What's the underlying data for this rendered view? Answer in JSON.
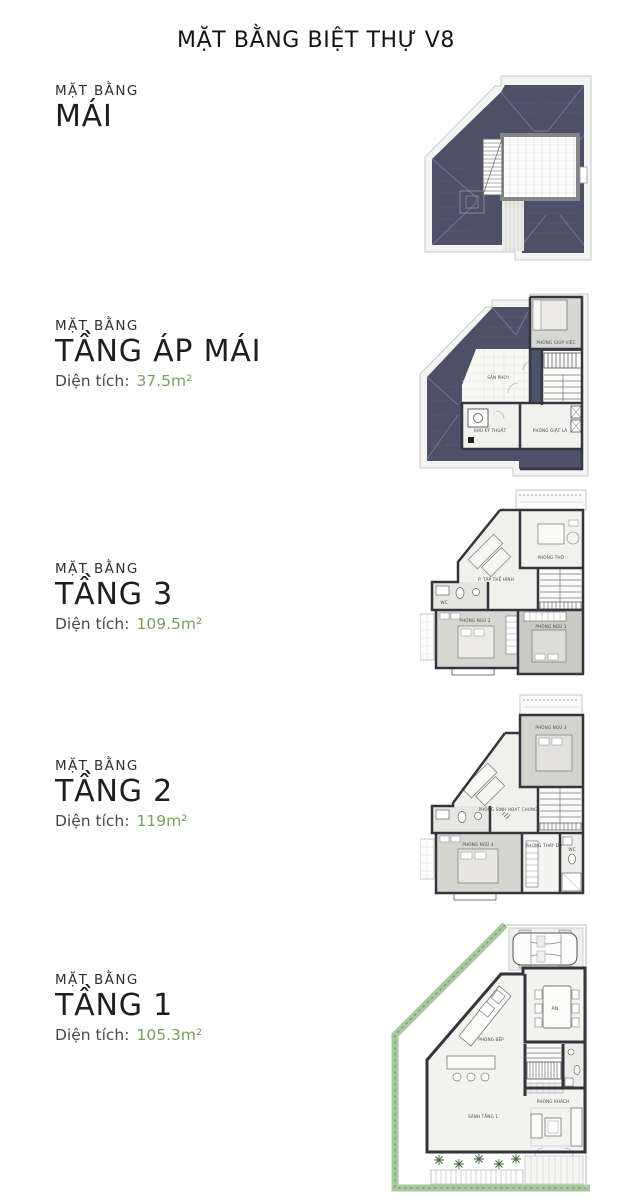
{
  "page": {
    "title": "MẶT BẰNG BIỆT THỰ V8"
  },
  "colors": {
    "accent_green": "#7aa05f",
    "roof_fill": "#4c5068",
    "wall": "#34363e",
    "hedge_green": "#9cc494"
  },
  "sections": [
    {
      "label": "MẶT BẰNG",
      "name": "MÁI"
    },
    {
      "label": "MẶT BẰNG",
      "name": "TẦNG ÁP MÁI",
      "area_label": "Diện tích:",
      "area_value": "37.5m²"
    },
    {
      "label": "MẶT BẰNG",
      "name": "TẦNG 3",
      "area_label": "Diện tích:",
      "area_value": "109.5m²"
    },
    {
      "label": "MẶT BẰNG",
      "name": "TẦNG 2",
      "area_label": "Diện tích:",
      "area_value": "119m²"
    },
    {
      "label": "MẶT BẰNG",
      "name": "TẦNG 1",
      "area_label": "Diện tích:",
      "area_value": "105.3m²"
    }
  ],
  "plans": {
    "attic": {
      "rooms": {
        "maid": "PHÒNG GIÚP VIỆC",
        "drying": "SÂN PHƠI",
        "technical": "KHU KỸ THUẬT",
        "laundry": "PHÒNG GIẶT LÀ"
      }
    },
    "floor3": {
      "rooms": {
        "worship": "PHÒNG THỜ",
        "gym": "P. TẬP THỂ HÌNH",
        "bedroom2": "PHÒNG NGỦ 2",
        "bedroom1": "PHÒNG NGỦ 1",
        "wc": "WC"
      }
    },
    "floor2": {
      "rooms": {
        "bedroom3": "PHÒNG NGỦ 3",
        "common": "PHÒNG SINH HOẠT CHUNG",
        "bedroom4": "PHÒNG NGỦ 4",
        "dressing": "PHÒNG THAY ĐỒ",
        "wc": "WC"
      }
    },
    "floor1": {
      "rooms": {
        "dining": "ĂN",
        "kitchen": "PHÒNG BẾP",
        "hall": "SẢNH TẦNG 1",
        "living": "PHÒNG KHÁCH"
      }
    }
  }
}
